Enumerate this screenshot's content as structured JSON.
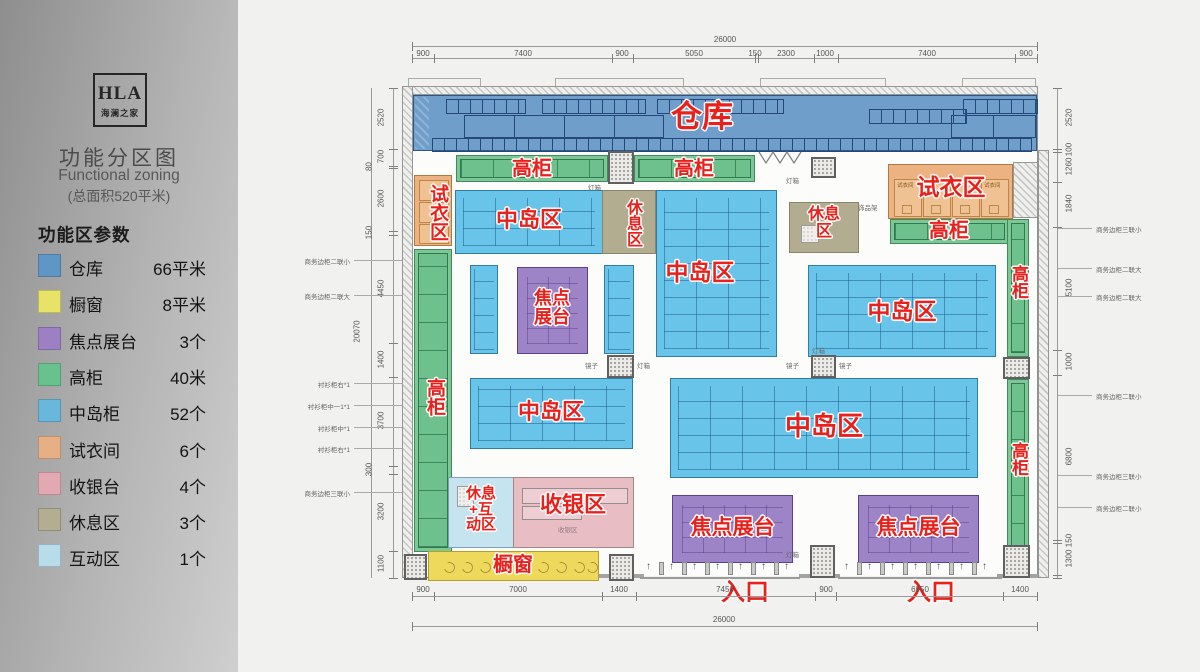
{
  "sidebar": {
    "logo": {
      "title": "HLA",
      "subtitle": "海澜之家"
    },
    "title": "功能分区图",
    "subtitle": "Functional zoning",
    "area_note": "(总面积520平米)",
    "legend_title": "功能区参数",
    "legend": [
      {
        "name": "仓库",
        "value": "66平米",
        "color": "#5e97c6"
      },
      {
        "name": "橱窗",
        "value": "8平米",
        "color": "#e7e369"
      },
      {
        "name": "焦点展台",
        "value": "3个",
        "color": "#9d80c4"
      },
      {
        "name": "高柜",
        "value": "40米",
        "color": "#68c28d"
      },
      {
        "name": "中岛柜",
        "value": "52个",
        "color": "#6ab7dc"
      },
      {
        "name": "试衣间",
        "value": "6个",
        "color": "#e7af85"
      },
      {
        "name": "收银台",
        "value": "4个",
        "color": "#e2a9b3"
      },
      {
        "name": "休息区",
        "value": "3个",
        "color": "#b3ad92"
      },
      {
        "name": "互动区",
        "value": "1个",
        "color": "#b9dcea"
      }
    ]
  },
  "plan": {
    "labels": {
      "warehouse": "仓库",
      "cabinet": "高柜",
      "fitting": "试衣区",
      "island": "中岛区",
      "rest": "休息区",
      "focus": "焦点展台",
      "cashier": "收银区",
      "rest_interact": "休息+互动区",
      "window": "橱窗",
      "entrance": "入口",
      "arrow": "↑"
    },
    "tiny": {
      "light_box": "灯箱",
      "mirror": "镜子",
      "accessory_rack": "饰品架",
      "fitting_room": "试衣间",
      "cashier_small": "收银区"
    },
    "dims": {
      "top_total": "26000",
      "top": [
        "900",
        "7400",
        "900",
        "5050",
        "150",
        "2300",
        "1000",
        "7400",
        "900"
      ],
      "bottom": [
        "900",
        "7000",
        "1400",
        "7450",
        "900",
        "6950",
        "1400"
      ],
      "bottom_total": "26000",
      "left_total": "20070",
      "left": [
        "2520",
        "700",
        "80",
        "2600",
        "150",
        "4450",
        "1400",
        "3700",
        "300",
        "3200",
        "1100"
      ],
      "right": [
        "2520",
        "100",
        "1260",
        "1840",
        "5100",
        "1000",
        "6800",
        "150",
        "1300"
      ]
    },
    "annotations": {
      "left": [
        "商务边柜二联小",
        "商务边柜二联大",
        "衬衫柜右*1",
        "衬衫柜中一1*1",
        "衬衫柜中*1",
        "衬衫柜右*1",
        "商务边柜三联小"
      ],
      "right": [
        "商务边柜三联小",
        "商务边柜二联大",
        "商务边柜二联大",
        "商务边柜二联小",
        "商务边柜三联小",
        "商务边柜二联小"
      ]
    },
    "colors": {
      "label_red": "#e8211c",
      "warehouse": "#6f9ecb",
      "island": "#68c4e8",
      "cabinet": "#7dc795",
      "fitting": "#ecb282",
      "rest": "#b2ac91",
      "focus": "#9d84c7",
      "cashier": "#e9bdc4",
      "interact": "#c6e4f0",
      "window": "#efd95d"
    }
  }
}
